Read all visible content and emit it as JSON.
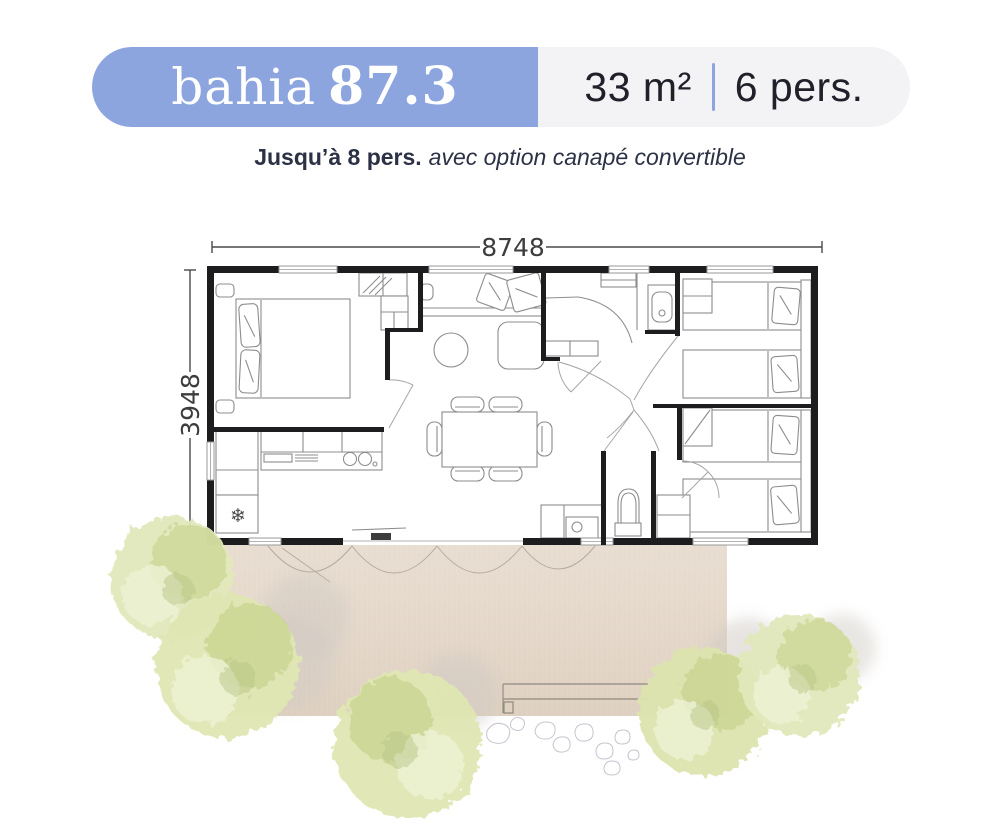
{
  "header": {
    "name": "bahia",
    "number": "87.3",
    "area": "33 m²",
    "capacity": "6 pers.",
    "subtitle_bold": "Jusqu’à 8 pers.",
    "subtitle_rest": "avec option canapé convertible"
  },
  "dimensions": {
    "width_mm": "8748",
    "depth_mm": "3948"
  },
  "icons": {
    "fridge_snowflake": "❄"
  },
  "colors": {
    "brand_blue": "#8da5df",
    "badge_bg": "#f3f3f5",
    "text_dark": "#20202a",
    "subtitle": "#2c3145",
    "wall": "#1d1d1f",
    "line": "#8d8d8d",
    "terrace": "#e6dacc",
    "tree_fill": "#dbe3ae"
  }
}
